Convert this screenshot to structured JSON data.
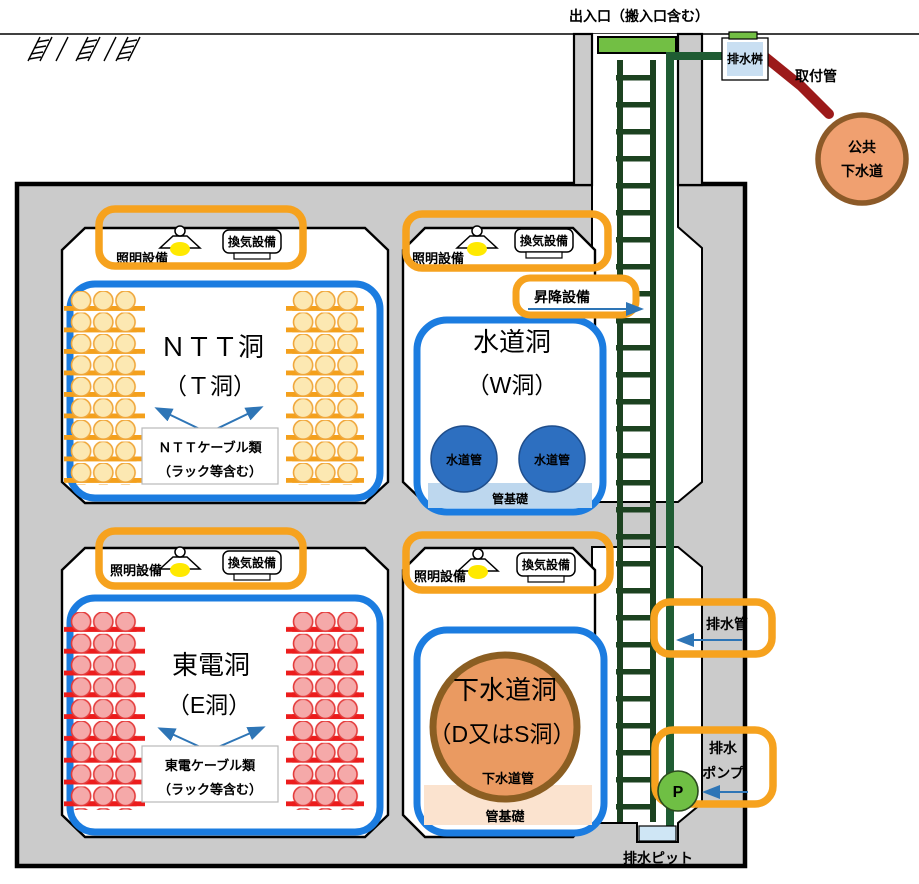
{
  "labels": {
    "entrance": "出入口（搬入口含む）",
    "drainage_basin": "排水桝",
    "attachment_pipe": "取付管",
    "public_sewer_line1": "公共",
    "public_sewer_line2": "下水道",
    "lift": "昇降設備",
    "drain_pipe": "排水管",
    "drain_pump_line1": "排水",
    "drain_pump_line2": "ポンプ",
    "pump_symbol": "P",
    "drain_pit": "排水ピット"
  },
  "chambers": {
    "ntt": {
      "title": "ＮＴＴ洞",
      "subtitle": "（Ｔ洞）",
      "cables_line1": "ＮＴＴケーブル類",
      "cables_line2": "（ラック等含む）",
      "lighting": "照明設備",
      "ventilation": "換気設備"
    },
    "water": {
      "title": "水道洞",
      "subtitle": "（W洞）",
      "pipe": "水道管",
      "foundation": "管基礎",
      "lighting": "照明設備",
      "ventilation": "換気設備"
    },
    "touden": {
      "title": "東電洞",
      "subtitle": "（E洞）",
      "cables_line1": "東電ケーブル類",
      "cables_line2": "（ラック等含む）",
      "lighting": "照明設備",
      "ventilation": "換気設備"
    },
    "sewer": {
      "title": "下水道洞",
      "subtitle": "（D又はS洞）",
      "pipe": "下水道管",
      "foundation": "管基礎",
      "lighting": "照明設備",
      "ventilation": "換気設備"
    }
  },
  "colors": {
    "highlight_orange": "#F6A21E",
    "tunnel_blue": "#1B7CE0",
    "arrow_blue": "#2E75B6",
    "ladder_green": "#1C4220",
    "pipe_green": "#1F5C33",
    "hatch_cover_green": "#72BF44",
    "ntt_cable_fill": "#FCE8B2",
    "ntt_rack_orange": "#F4A01C",
    "touden_cable_fill": "#F5A9A9",
    "touden_rack_red": "#EC1C1C",
    "water_pipe_blue": "#2D6FC0",
    "water_foundation_blue": "#BDD7EE",
    "sewer_circle_fill": "#EA9A61",
    "sewer_circle_stroke": "#8B5E22",
    "sewer_foundation_peach": "#FBE3CF",
    "public_sewer_fill": "#F0A070",
    "public_sewer_stroke": "#8C5A28",
    "attachment_pipe_red": "#9C1A1A",
    "pump_green": "#6FBF44",
    "pit_blue": "#CFE6F5",
    "box_gray": "#CBCBCB"
  }
}
